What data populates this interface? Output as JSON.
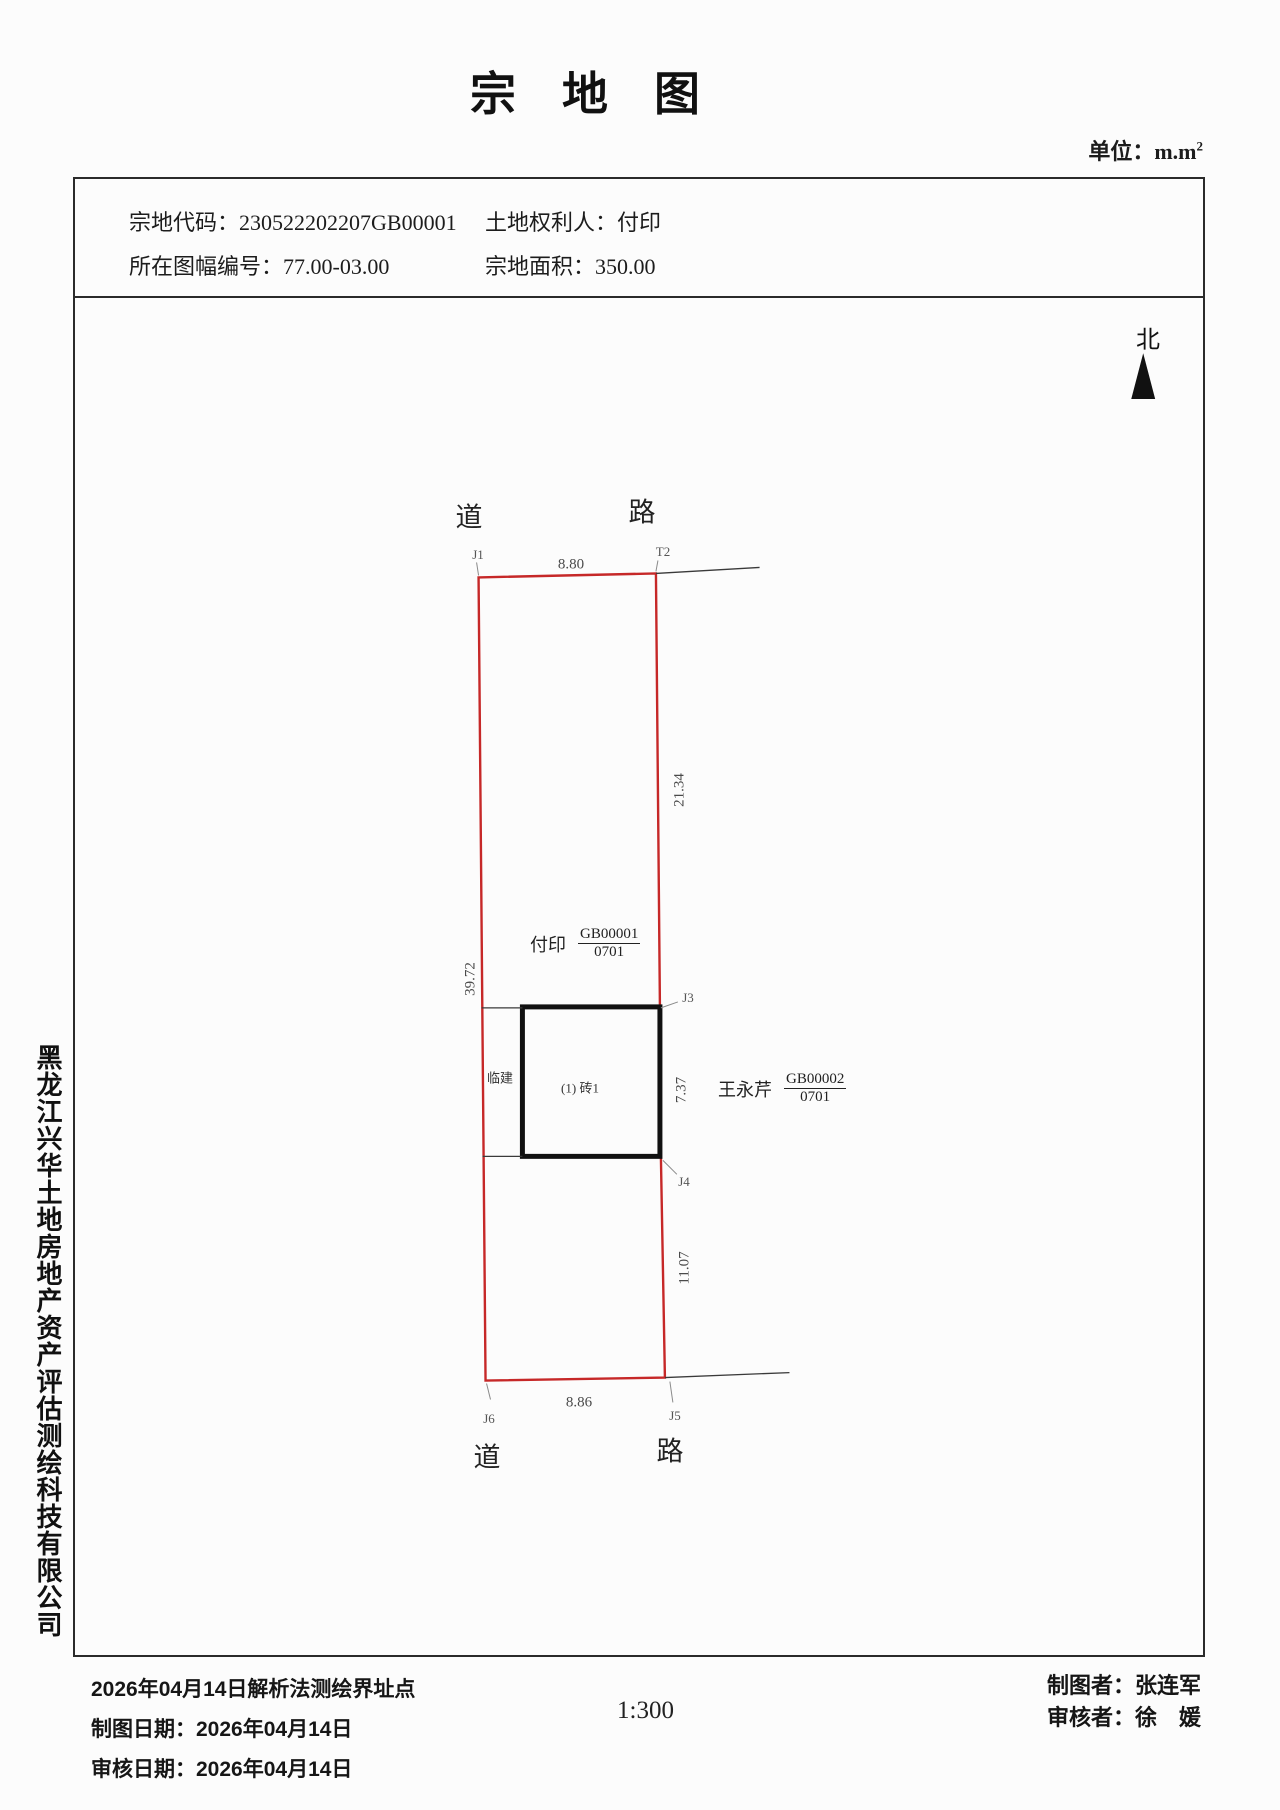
{
  "page": {
    "title": "宗　地　图",
    "unit_prefix": "单位：m.m",
    "unit_sup": "2"
  },
  "header": {
    "rows": [
      {
        "left_label": "宗地代码：",
        "left_value": "230522202207GB00001",
        "right_label": "土地权利人：",
        "right_value": "付印"
      },
      {
        "left_label": "所在图幅编号：",
        "left_value": "77.00-03.00",
        "right_label": "宗地面积：",
        "right_value": "350.00"
      }
    ]
  },
  "map": {
    "north": "北",
    "roads": {
      "top_left": "道",
      "top_right": "路",
      "bottom_left": "道",
      "bottom_right": "路"
    },
    "points": {
      "j1": "J1",
      "t2": "T2",
      "j3": "J3",
      "j4": "J4",
      "j5": "J5",
      "j6": "J6"
    },
    "dims": {
      "top": "8.80",
      "right_upper": "21.34",
      "left": "39.72",
      "building_right": "7.37",
      "right_lower": "11.07",
      "bottom": "8.86"
    },
    "parcel": {
      "owner": "付印",
      "code": "GB00001",
      "subcode": "0701"
    },
    "neighbor": {
      "owner": "王永芹",
      "code": "GB00002",
      "subcode": "0701"
    },
    "building": "(1) 砖1",
    "temp_building": "临建"
  },
  "sidebar": {
    "company": "黑龙江兴华土地房地产资产评估测绘科技有限公司"
  },
  "footer": {
    "survey_note": "2026年04月14日解析法测绘界址点",
    "lines": [
      {
        "label": "制图日期：",
        "value": "2026年04月14日"
      },
      {
        "label": "审核日期：",
        "value": "2026年04月14日"
      }
    ],
    "scale": "1:300",
    "drafter_label": "制图者：",
    "drafter": "张连军",
    "reviewer_label": "审核者：",
    "reviewer": "徐　媛"
  },
  "colors": {
    "boundary": "#c62828",
    "ink": "#1c1c1c"
  }
}
